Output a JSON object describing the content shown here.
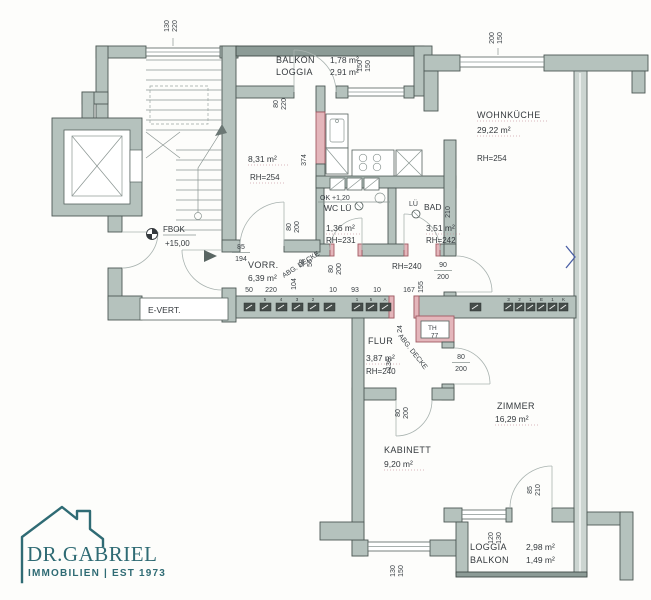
{
  "colors": {
    "wall": "#b5c2bd",
    "wall_dark": "#8c9b96",
    "wall_light": "#ccd5d1",
    "new_wall_pink": "#e4b6bb",
    "logo_teal": "#2f6b74",
    "marker_blue": "#4a5fa5"
  },
  "logo": {
    "name": "DR.GABRIEL",
    "tagline": "IMMOBILIEN | EST 1973"
  },
  "rooms": {
    "balkon_top": {
      "name_line1": "BALKON",
      "name_line2": "LOGGIA",
      "area1": "1,78 m²",
      "area2": "2,91 m²"
    },
    "zimmer831": {
      "area": "8,31 m²",
      "rh": "RH=254"
    },
    "wohnkueche": {
      "name": "WOHNKÜCHE",
      "area": "29,22 m²",
      "rh": "RH=254"
    },
    "wc": {
      "name": "WC LÜ",
      "area": "1,36 m²",
      "rh": "RH=231",
      "ok_line": "OK +1,20"
    },
    "bad": {
      "lu": "LÜ",
      "name": "BAD",
      "area": "3,51 m²",
      "rh": "RH=242"
    },
    "vorraum": {
      "name": "VORR.",
      "area": "6,39 m²",
      "abg": "ABG. DECKE",
      "rh": "RH=240"
    },
    "flur": {
      "name": "FLUR",
      "area": "3,87 m²",
      "rh": "RH=240",
      "abg": "ABG. DECKE"
    },
    "th": {
      "name": "TH",
      "value": "77"
    },
    "zimmer": {
      "name": "ZIMMER",
      "area": "16,29 m²"
    },
    "kabinett": {
      "name": "KABINETT",
      "area": "9,20 m²"
    },
    "loggia_bottom": {
      "name_line1": "LOGGIA",
      "name_line2": "BALKON",
      "area1": "2,98 m²",
      "area2": "1,49 m²"
    },
    "evert": {
      "name": "E-VERT."
    },
    "fbok": {
      "label": "FBOK",
      "level": "+15,00"
    }
  },
  "door_sizes": {
    "s130_220": {
      "w": "130",
      "h": "220"
    },
    "s80_220": {
      "w": "80",
      "h": "220"
    },
    "s150_150": {
      "w": "150",
      "h": "150"
    },
    "s200_150": {
      "w": "200",
      "h": "150"
    },
    "s85_194": {
      "w": "85",
      "h": "194"
    },
    "s80_200": {
      "w": "80",
      "h": "200"
    },
    "s90_200": {
      "w": "90",
      "h": "200"
    },
    "s85_210": {
      "w": "85",
      "h": "210"
    },
    "s120_130": {
      "w": "120",
      "h": "130"
    },
    "s130_150": {
      "w": "130",
      "h": "150"
    },
    "s58_56": {
      "w": "58",
      "h": "56"
    }
  },
  "dims": {
    "chain": [
      "50",
      "220",
      "10",
      "93",
      "10",
      "167"
    ],
    "d374": "374",
    "d104": "104",
    "d210": "210",
    "d155": "155",
    "d24": "24",
    "d136": "136"
  },
  "meters": {
    "group_a": [
      "5",
      "4",
      "3",
      "2"
    ],
    "group_b": [
      "1",
      "5",
      "A"
    ],
    "group_c": [
      "3",
      "2",
      "1",
      "E",
      "1",
      "K"
    ]
  }
}
